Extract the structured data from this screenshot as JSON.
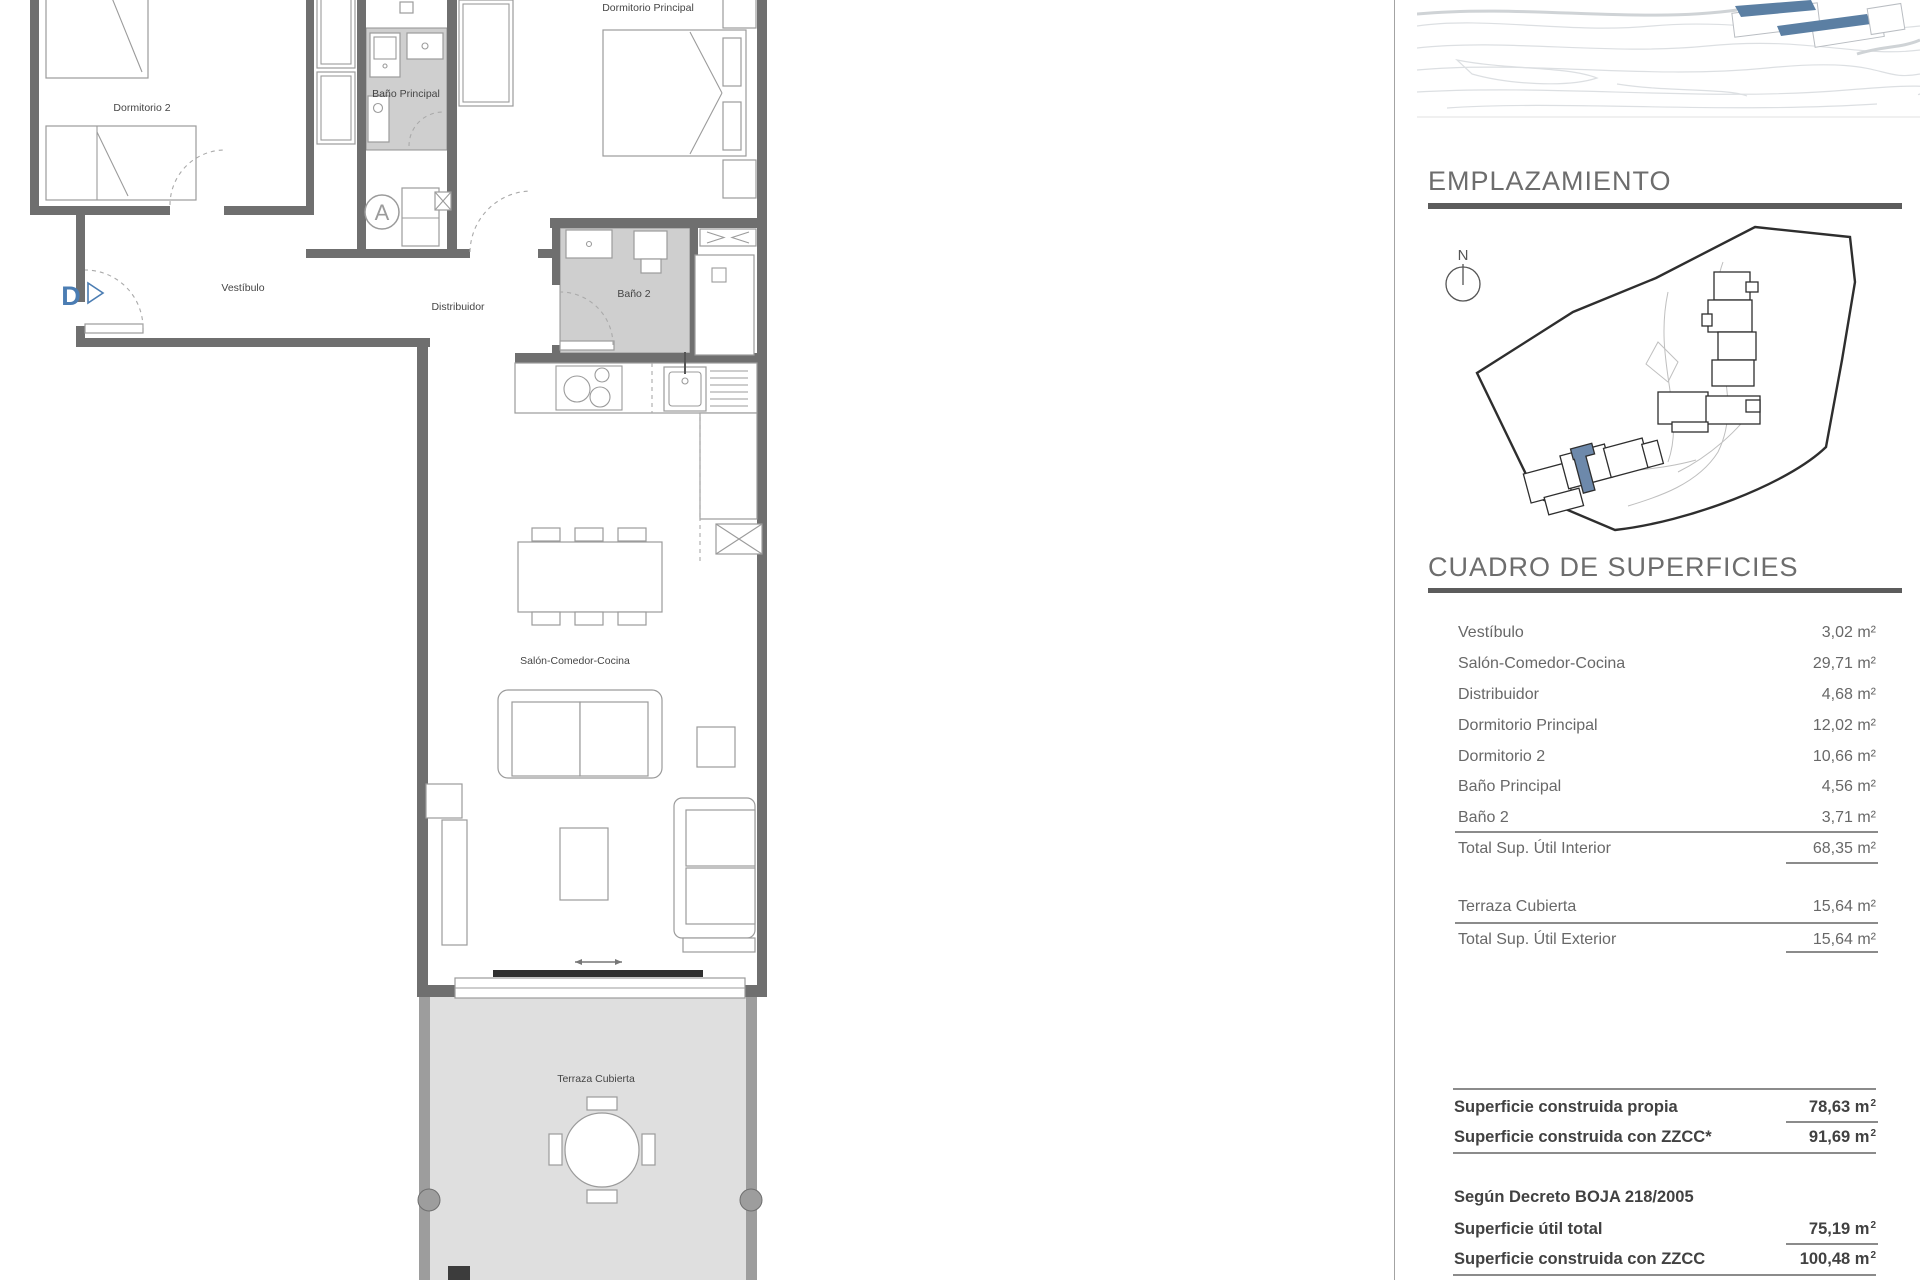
{
  "floor_plan": {
    "labels": {
      "dormitorio_2": "Dormitorio 2",
      "bano_principal": "Baño Principal",
      "dormitorio_principal": "Dormitorio Principal",
      "vestibulo": "Vestíbulo",
      "distribuidor": "Distribuidor",
      "bano_2": "Baño 2",
      "salon_comedor_cocina": "Salón-Comedor-Cocina",
      "terraza_cubierta": "Terraza Cubierta"
    },
    "markers": {
      "core": "A",
      "entrance": "D"
    }
  },
  "emplazamiento": {
    "title": "EMPLAZAMIENTO",
    "north": "N"
  },
  "superficies": {
    "title": "CUADRO DE SUPERFICIES",
    "interior": {
      "rows": [
        {
          "label": "Vestíbulo",
          "value": "3,02 m²"
        },
        {
          "label": "Salón-Comedor-Cocina",
          "value": "29,71 m²"
        },
        {
          "label": "Distribuidor",
          "value": "4,68 m²"
        },
        {
          "label": "Dormitorio Principal",
          "value": "12,02 m²"
        },
        {
          "label": "Dormitorio 2",
          "value": "10,66 m²"
        },
        {
          "label": "Baño Principal",
          "value": "4,56 m²"
        },
        {
          "label": "Baño 2",
          "value": "3,71 m²"
        }
      ],
      "total": {
        "label": "Total Sup. Útil Interior",
        "value": "68,35 m²"
      }
    },
    "exterior": {
      "rows": [
        {
          "label": "Terraza Cubierta",
          "value": "15,64 m²"
        }
      ],
      "total": {
        "label": "Total Sup. Útil Exterior",
        "value": "15,64 m²"
      }
    }
  },
  "summary": {
    "construida_propia": {
      "label": "Superficie construida propia",
      "value": "78,63 m",
      "sup": "2"
    },
    "construida_zzcc": {
      "label": "Superficie construida con ZZCC*",
      "value": "91,69 m",
      "sup": "2"
    },
    "decree_title": "Según Decreto BOJA 218/2005",
    "util_total": {
      "label": "Superficie útil total",
      "value": "75,19 m",
      "sup": "2"
    },
    "decree_zzcc": {
      "label": "Superficie construida con ZZCC",
      "value": "100,48 m",
      "sup": "2"
    }
  },
  "colors": {
    "accent_blue": "#4b7db3",
    "site_unit_blue": "#6d89ab",
    "aerial_blue": "#5b7fa3",
    "wall_gray": "#6f6f6f",
    "room_gray": "#cfcfcf",
    "terrace_gray": "#dfdfdf",
    "heading_gray": "#6d6d6d"
  }
}
